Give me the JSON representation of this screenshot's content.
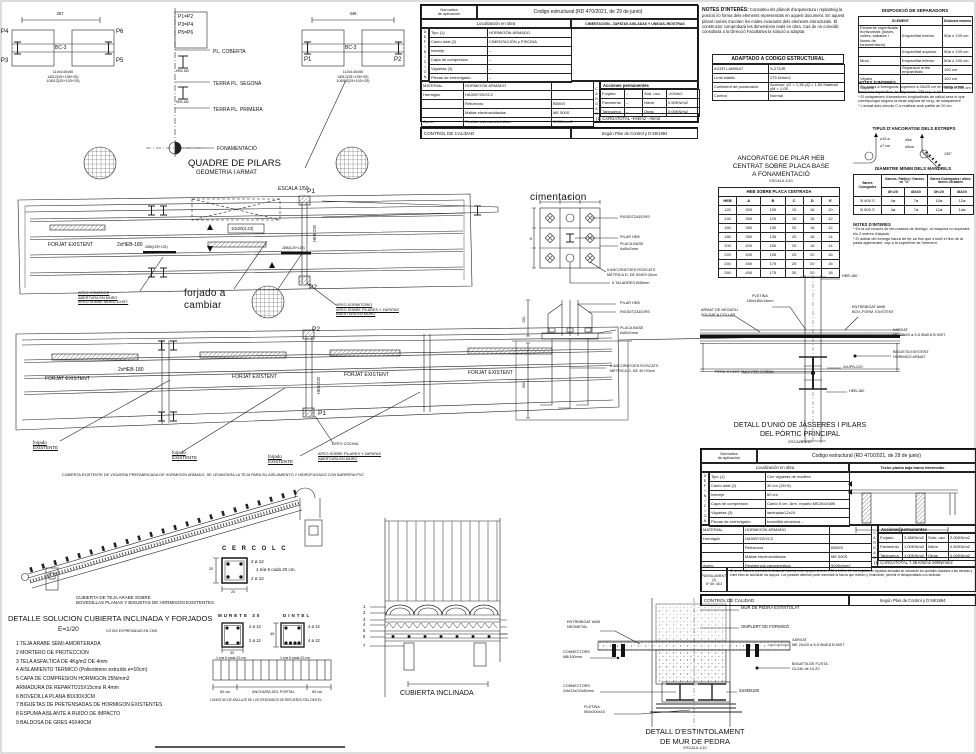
{
  "colors": {
    "ink": "#222222",
    "paper": "#ffffff"
  },
  "pilar_a": {
    "dim": "357",
    "p4": "P4",
    "p6": "P6",
    "p3": "P3",
    "p5": "P5",
    "beam": "BC-3",
    "notes": "110x140x50\n4Ø12(25+135+25)\n10Ø12(25+100+25)"
  },
  "pilar_b": {
    "dim": "346",
    "p1": "P1",
    "p2": "P2",
    "beam": "BC-3",
    "notes": "110x140x50\n4Ø12(25+135+25)\n10Ø12(25+100+25)"
  },
  "quadre": {
    "eqs": "P1=P2\nP3=P4\nP5=P6",
    "lvl1": "PL. COBERTA",
    "lvl2": "TERRA PL. SEGONA",
    "lvl3": "TERRA PL. PRIMERA",
    "lvl4": "FONAMENTACIÓ",
    "profile": "HEB-180",
    "title": "QUADRE DE PILARS",
    "subtitle": "GEOMETRIA I ARMAT",
    "scale": "ESCALA 1/50"
  },
  "norm1": {
    "h_label": "Normativa\nde aplicación",
    "h_value": "Codigo estructural (RD 470/2021, de 29 de junio)",
    "loc_label": "Localización en obra",
    "loc_value": "CIMENTACIÓN– ZAPATAS AISLADAS Y UNIDAS–RIOSTRAS",
    "def_letters": "DEFINICION",
    "def_rows": [
      [
        "Tipo (1)",
        "HORMIGÓN ARMADO"
      ],
      [
        "Canto total (2)",
        "CIMENTACIÓN y PISCINA"
      ],
      [
        "Intereje",
        "–"
      ],
      [
        "Capa de compresión",
        "–"
      ],
      [
        "Viguetas (3)",
        "–"
      ],
      [
        "Piezas de entrevigado",
        "–"
      ]
    ],
    "mat_rows": [
      [
        "MATERIAL",
        "HORMIGÓN ARMADO",
        ""
      ],
      [
        "Hormigón",
        "HA30/F/20/XC2",
        ""
      ],
      [
        "",
        "Refuerzos",
        "B500S"
      ],
      [
        "",
        "Mallas electrosoldadas",
        "ME 500S"
      ],
      [
        "Acero",
        "Resistencia característica",
        "500N/mm2"
      ]
    ],
    "cargas_letters": "CARGAS",
    "acc_title": "Acciones permanentes",
    "cargas_rows": [
      [
        "Forjado",
        "–",
        "Sob. uso",
        "–KN/m2"
      ],
      [
        "Pavimento",
        "–",
        "Nieve",
        "0.50KN/m2"
      ],
      [
        "Tabiquería",
        "–",
        "Otras",
        "0.00KN/m2"
      ]
    ],
    "total": "(1)  CARGATOTAL   –KN/m2    –/mm2",
    "control_label": "CONTROL DE CALIDAD",
    "control_value": "Según Plan de Control y D 59/1994"
  },
  "notes_interes": {
    "title": "NOTES D'INTERÉS:",
    "body": "Consulteu els plànols d'arquitectura i replanteig la posició i/o forma dels elements representats en aquest document. En aquest plànol només s'acoten les mides invariants dels elements estructurals. El constructor comprobarà les dimensions reals en obra. Cas de no coincidir, consultarà a la Direcció Facultativa la solució a adoptar."
  },
  "acer": {
    "title": "ADAPTADO A CODIGO ESTRUCTURAL",
    "rows": [
      [
        "ACER LAMINAT",
        "S-275JR"
      ],
      [
        "Límit elàstic",
        "275 N/mm2"
      ],
      [
        "Coeficient de ponderació",
        "Accions: γG = 1,35  γQ = 1,50  Material γM = 1,05"
      ],
      [
        "Control",
        "Normal"
      ]
    ]
  },
  "separadors": {
    "title": "DISPOSICIÓ DE SEPARADORS",
    "col1": "ELEMENT",
    "col2": "Distància màxima",
    "rows": [
      [
        "Elements superficials horitzontals (lloses, voltes, sàbates i lloses de fonamentació)",
        "Emparrillat inferior",
        "50ø o 100 cm"
      ],
      [
        "",
        "Emparrillat superior",
        "50ø o 100 cm"
      ],
      [
        "Murs",
        "Emparrillat inferior",
        "50ø o 100 cm"
      ],
      [
        "",
        "Separació entre emparrillats",
        "100 cm"
      ],
      [
        "Vigues",
        "",
        "100 cm"
      ],
      [
        "Suports",
        "",
        "100ø o 200 cm"
      ]
    ],
    "notes_title": "NOTES D'INTERÉS",
    "notes": "* En zones a formigonar superiors a 25x25 cm en planta sense armadura específica, es disposarà 1Ø8 sup. e inf.\n* El solapament d'armadures longitudinals de càlcul serà el que correspongui segons la taula adjunta de long. de solapament\n* L'armat dels cèrcols C-s realitzat amb patilla de 20 cm."
  },
  "estreps": {
    "title": "TIPUS D'ANCORATGE DELS ESTREPS",
    "d1a": "≥10 ø",
    "d1b": "≥7 cm",
    "d2a": "≥5ø",
    "d2b": "≥5cm",
    "angle": "135°"
  },
  "mandrils": {
    "title": "DIÀMETRE MÍNIM DELS MANDRILS",
    "h0": "Barres Corrugades",
    "h1": "Ganxos, Patilles i Ganxos en \"U\"",
    "h2": "Barres Doblegades i altres barres corbades",
    "sub": [
      "Ø<20",
      "Ø≥20",
      "Ø<20",
      "Ø≥20"
    ],
    "rows": [
      [
        "B 400 S",
        "4ø",
        "7ø",
        "10ø",
        "12ø"
      ],
      [
        "B 500 S",
        "4ø",
        "7ø",
        "12ø",
        "14ø"
      ]
    ],
    "notes_title": "NOTES D'INTERÉS",
    "notes": "* En la col·locació de les masses de formigó, la màquina no superarà els 2 metres d'alçada.\n* El doblat del formigó haurà de fer-se fins que s'iniciï el flux de la pasta aglomerant, cap a la superfície de l'element."
  },
  "plan1": {
    "forjat": "FORJAT EXISTENT",
    "beam": "2xHEB-180",
    "box": "10x20(4.23)",
    "reinf": "2Ø8(125+125)",
    "p1": "P1",
    "p2": "P2",
    "heb": "HEB-220",
    "scale": "ESCALA 1/50",
    "hand": "forjado a\ncambiar",
    "apeo1": "APEO COMEDOR\nABERTURA EN MURO\nAPEO SOBRE MURO EXIST.",
    "apeo2": "APEO DORMITORIO\nAPEO SOBRE PILARES Y ZAPATAS\nABERTURA EN MURO"
  },
  "plan2": {
    "forjat": "FORJAT EXISTENT",
    "beam": "2xHEB-180",
    "heb": "HEB-220",
    "p1": "P1",
    "p2": "P2",
    "existing": "forjado\nEXISTENTE",
    "apeo_title": "APEO COCINA",
    "apeo_sub": "APEO SOBRE PILARES Y ZAPATAS\nABERTURA EN MURO"
  },
  "ciment": {
    "title": "cimentacion",
    "l1": "RIGIDITZADORS",
    "l2": "PILAR HEB",
    "l3": "PLACA BASE\nAxBxGmm",
    "l4": "6 ANCORATGES ROSCATS\nMÈTRICA D, DE 50/40+20cm",
    "l5": "6 TALADRES Ø45mm",
    "e1": "PILAR HEB",
    "e2": "RIGIDITZADORS",
    "e3": "PLACA BASE\nAxBxGmm",
    "e4": "6 ANCORATGES ROSCATS\nMÈTRICA D, DE 40+20cm",
    "dim_a_top": "A",
    "dim_a_left": "A",
    "dim_150": "150",
    "dim_500": "500"
  },
  "heb": {
    "t1": "ANCORATGE DE PILAR HEB",
    "t2": "CENTRAT SOBRE PLACA BASE",
    "t3": "A FONAMENTACIÓ",
    "scale": "ESCALA 1/10",
    "band": "HEB SOBRE PLACA CENTRADA",
    "cols": [
      "HEB",
      "A",
      "B",
      "C",
      "D",
      "E"
    ],
    "rows": [
      [
        "120",
        "300",
        "105",
        "15",
        "16",
        "10"
      ],
      [
        "140",
        "350",
        "125",
        "15",
        "16",
        "12"
      ],
      [
        "160",
        "350",
        "130",
        "20",
        "16",
        "12"
      ],
      [
        "180",
        "350",
        "135",
        "20",
        "16",
        "14"
      ],
      [
        "200",
        "400",
        "150",
        "20",
        "16",
        "14"
      ],
      [
        "220",
        "400",
        "155",
        "25",
        "20",
        "16"
      ],
      [
        "240",
        "450",
        "175",
        "25",
        "20",
        "16"
      ],
      [
        "260",
        "450",
        "175",
        "30",
        "20",
        "18"
      ]
    ]
  },
  "unio": {
    "heb_top": "HEB-180",
    "pletina": "PLETINA\n180x180x14mm",
    "armat": "ARMAT DE NEGATIU\nSOLDAT A COLLAR",
    "entrebigat": "ENTREBIGAT AMB\nBOV.-FORM. EXISTENT",
    "xarxat": "XARXAT\nME 20x20 ø 5-5 ØxØ,8 B 500T",
    "bigueta": "BIGUETA EXISTENT\nHORMIGÓ ARMAT",
    "upn": "2xUPN-220",
    "pern": "PERN D'UNIÓ 2M12 PER CORBA",
    "heb_bot": "HEB-180",
    "t1": "DETALL D'UNIÓ DE JÀSSERES I PILARS",
    "t2": "DEL PÒRTIC PRINCIPAL",
    "scale": "ESCALA 1/10"
  },
  "norm2": {
    "h_label": "Normativa\nde aplicación",
    "h_value": "Codigo estructural (RD 470/2021, de 29 de junio)",
    "loc_label": "Localización en obra",
    "loc_value": "Techo planta baja tramo intermedio",
    "def_letters": "DEFINICION",
    "def_rows": [
      [
        "Tipo (1)",
        "Con viguetas de madera"
      ],
      [
        "Canto total (2)",
        "30 cm (25+5)"
      ],
      [
        "Intereje",
        "60 cm"
      ],
      [
        "Capa de compresión",
        "Canto 5 cm. Arm. reparto ME20x20Ø5"
      ],
      [
        "Viguetas (3)",
        "laminada/12x24"
      ],
      [
        "Piezas de entrevigado",
        "bovedilla ceramica  –"
      ]
    ],
    "mat_rows": [
      [
        "MATERIAL",
        "HORMIGÓN ARMADO",
        ""
      ],
      [
        "Hormigón",
        "HA30/F/20/XC3",
        ""
      ],
      [
        "",
        "Refuerzos",
        "B500S"
      ],
      [
        "",
        "Mallas electrosoldadas",
        "ME 500S"
      ],
      [
        "Acero",
        "Resistencia característica",
        "500N/mm2"
      ]
    ],
    "cargas_letters": "CARGAS",
    "acc_title": "Acciones permanentes",
    "cargas_rows": [
      [
        "Forjado",
        "3.38KN/m2",
        "Sobr. uso",
        "2.00KN/m2"
      ],
      [
        "Pavimento",
        "1.00KN/m2",
        "Nieve",
        "0.50KN/m2"
      ],
      [
        "Tabiquería",
        "1.00KN/m2",
        "Otras",
        "0.00KN/m2"
      ]
    ],
    "total": "(1)  CARGATOTAL  7.38 KN/m2     500N/mm2",
    "apunt_label": "APUNTALAMIENTO\n(3)\nGº Art. 48.3",
    "apunt_text": "Si no se indica lo contrario la distancia máxima entre apoyos será de 1,00 a 1,20m. En los forjados de viguetas armadas se colocarán los puntales clavados a las mismas y entre ellos se acuñarán los apoyos. Los puntales deberán poder transmitir la fuerza que reciben y, finalmente, permitir el desapuntalado con facilidad.",
    "control_label": "CONTROL DE CALIDAD",
    "control_value": "Según Plan de Control y D 59/1994"
  },
  "roof": {
    "note_top": "CUBIERTA EXISTENTE DE VIGUERIA PREFABRICADA DE HORMIGON ARMADO. SE LEVANTARA LA TEJA PARA SU AISLAMIENTO Y HIDROFUGADO CON BARRERA PVC",
    "note_bottom": "CUBIERTA DE TEJA ARABE SOBRE\nBOVEDILLAS PLANAS Y BIGUETAS DE HORMIGON EXISTENTES"
  },
  "cercol": {
    "title": "C E R C O L  C",
    "top": "2 ø 12",
    "mid": "1 e/ø 6 cada 20 cm.",
    "bot": "2 ø 12",
    "dim_w": "20",
    "dim_h": "20"
  },
  "lista": {
    "title": "DETALLE SOLUCION CUBIERTA INCLINADA Y FORJADOS",
    "scale": "E=1/20",
    "note": "COTAS EXPRESADAS EN CMS.",
    "items": [
      "1   TEJA ARABE SEMI-AMORTERADA",
      "2   MORTERO DE PROTECCION",
      "3   TELA ASFALTICA DE 4Kg/m2 DE 4mm",
      "4   AISLAMIENTO TERMICO (Poliestireno extruído e=10cm)",
      "5   CAPA DE COMPRESION HORMIGON 25N/mm2",
      "     ARMADURA DE REPARTO15X15cms R.4mm",
      "6   BOVEDILLA PLANA 80X30X3CM",
      "7   BIGUETAS DE PRETENSADAS DE HORMIGON EXISTENTES",
      "8   ESPUMA AISLANTE A RUIDO DE IMPACTO",
      "9   BALDOSA DE GRES 40X40CM"
    ]
  },
  "murete": {
    "title": "MURETE 30",
    "a": "2 ø 12",
    "b": "2 ø 12",
    "e": "1 e/ø 6 cada 20 cm.",
    "dim": "30"
  },
  "dintel": {
    "title": "DINTEL",
    "a": "2 ø 12",
    "b": "4 ø 12",
    "e": "1 e/ø 6 cada 20 cm.",
    "dim": "45"
  },
  "portal": {
    "left": "60 cm",
    "center": "ANCHURA DEL PORTAL",
    "right": "60 cm",
    "caption": "LONGITUD DE ANCLAJE DE LOS REDONDOS DE REFUERZO DEL DINTEL"
  },
  "cubinc": {
    "title": "CUBIERTA INCLINADA",
    "nums": [
      "1",
      "2",
      "3",
      "4",
      "5",
      "6",
      "7"
    ]
  },
  "estint": {
    "l1": "MUR DE PEDRA ESTINTOLAT",
    "l2": "OMPLERT DE FORMIGÓ",
    "l3": "ENTREBIGAT AMB\nNEOMETAL",
    "l4": "XARXAT\nME 20x20 ø 5-5 ØxØ,8 B 500T",
    "l5": "BIGUETA DE FUSTA\nGL24h de 10-20",
    "l6": "CONNECTORS\nM8/150mm",
    "l7": "CONNECTORS\n2xM12s/20x80mm",
    "l8": "2xHEB180",
    "l9": "PLETINA\n500x300x15",
    "t1": "DETALL D'ESTINTOLAMENT",
    "t2": "DE MUR DE PEDRA",
    "scale": "ESCALA 1/10"
  }
}
